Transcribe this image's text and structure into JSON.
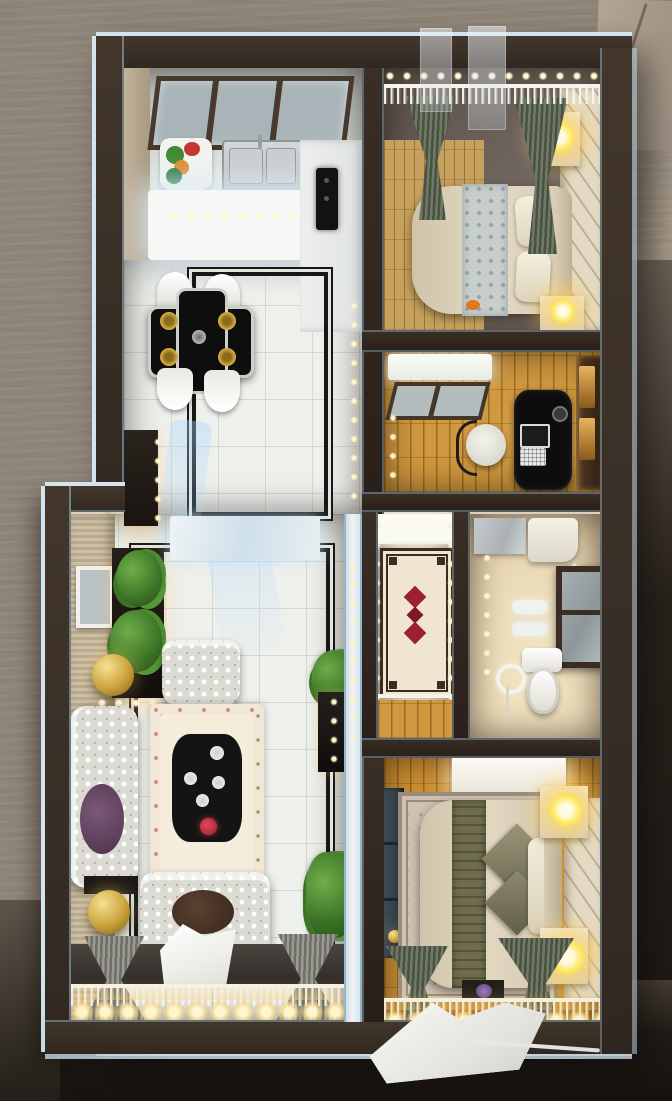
{
  "meta": {
    "label": "Top-down photo of an illuminated miniature apartment scale model on a plywood board",
    "media_type": "photograph",
    "text_content": "none"
  },
  "palette": {
    "plywood": "#8e8578",
    "plywood_light": "#a49887",
    "backdrop": "#1f1a16",
    "wall": "#312821",
    "trim": "#d3e4ef",
    "trim_blue": "#8fb6cc",
    "tile": "#eef0ec",
    "ink": "#171717",
    "wood": "#d0983f",
    "wood_tan": "#c6a05c",
    "cream": "#e4dac4",
    "bath": "#ead9b6",
    "sofa": "#dcdbd3",
    "curtain": "#49513f",
    "lamp": "#ffe75e",
    "gold": "#caa23c",
    "plant": "#3c7426",
    "rug_red": "#9c2030",
    "desk": "#0d0d0d"
  },
  "rooms": {
    "kitchen": {
      "label": "Kitchen with sink, window and lit counters"
    },
    "dining": {
      "label": "Dining area with black cross table, gold plates and four white chairs"
    },
    "hallway": {
      "label": "Tiled hallway with black inlay borders"
    },
    "living": {
      "label": "Living room with tufted sofas, floral rug, plants and gold wicker lamps"
    },
    "bedroom_master": {
      "label": "Master bedroom with bed, curtains and glowing bedside lamps"
    },
    "study": {
      "label": "Study with black desk, laptop and chair"
    },
    "corridor": {
      "label": "Corridor with red-medallion runner rug"
    },
    "bathroom": {
      "label": "Bathroom with vanity, toilet and framed shower panel"
    },
    "bedroom_second": {
      "label": "Second bedroom with bed, rug, wardrobe and lamps"
    }
  },
  "lighting": {
    "led_strip": "warm white LED strip along balcony windows",
    "led_dots": "small LED dots along interior walls",
    "bedside_lamps": 4
  }
}
